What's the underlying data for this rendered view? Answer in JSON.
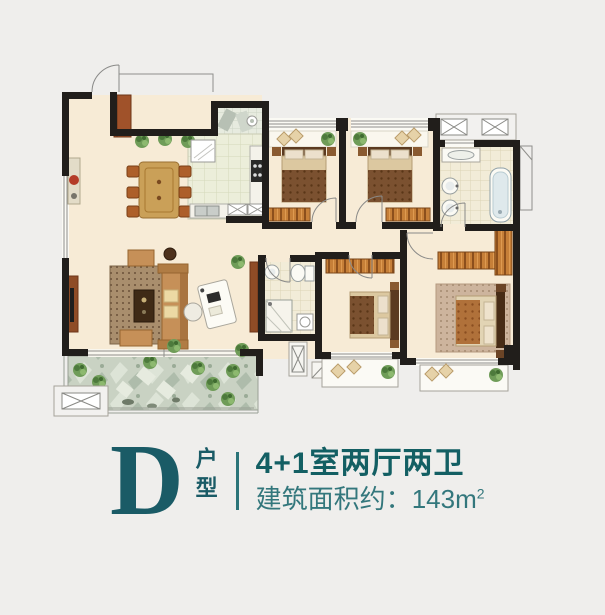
{
  "caption": {
    "unit_letter": "D",
    "unit_label": "户型",
    "layout_title": "4+1室两厅两卫",
    "area_label": "建筑面积约：",
    "area_value": "143m",
    "area_exponent": "2"
  },
  "colors": {
    "background": "#efeeec",
    "accent_teal": "#1a5b66",
    "accent_teal_light": "#33777c",
    "wall_black": "#211e1b",
    "floor_cream": "#f7ebd6",
    "kitchen_tile": "#eceeda",
    "bath_tile": "#f2ecd8",
    "balcony_green": "#c9d2c3",
    "wood_orange": "#c67f38"
  }
}
